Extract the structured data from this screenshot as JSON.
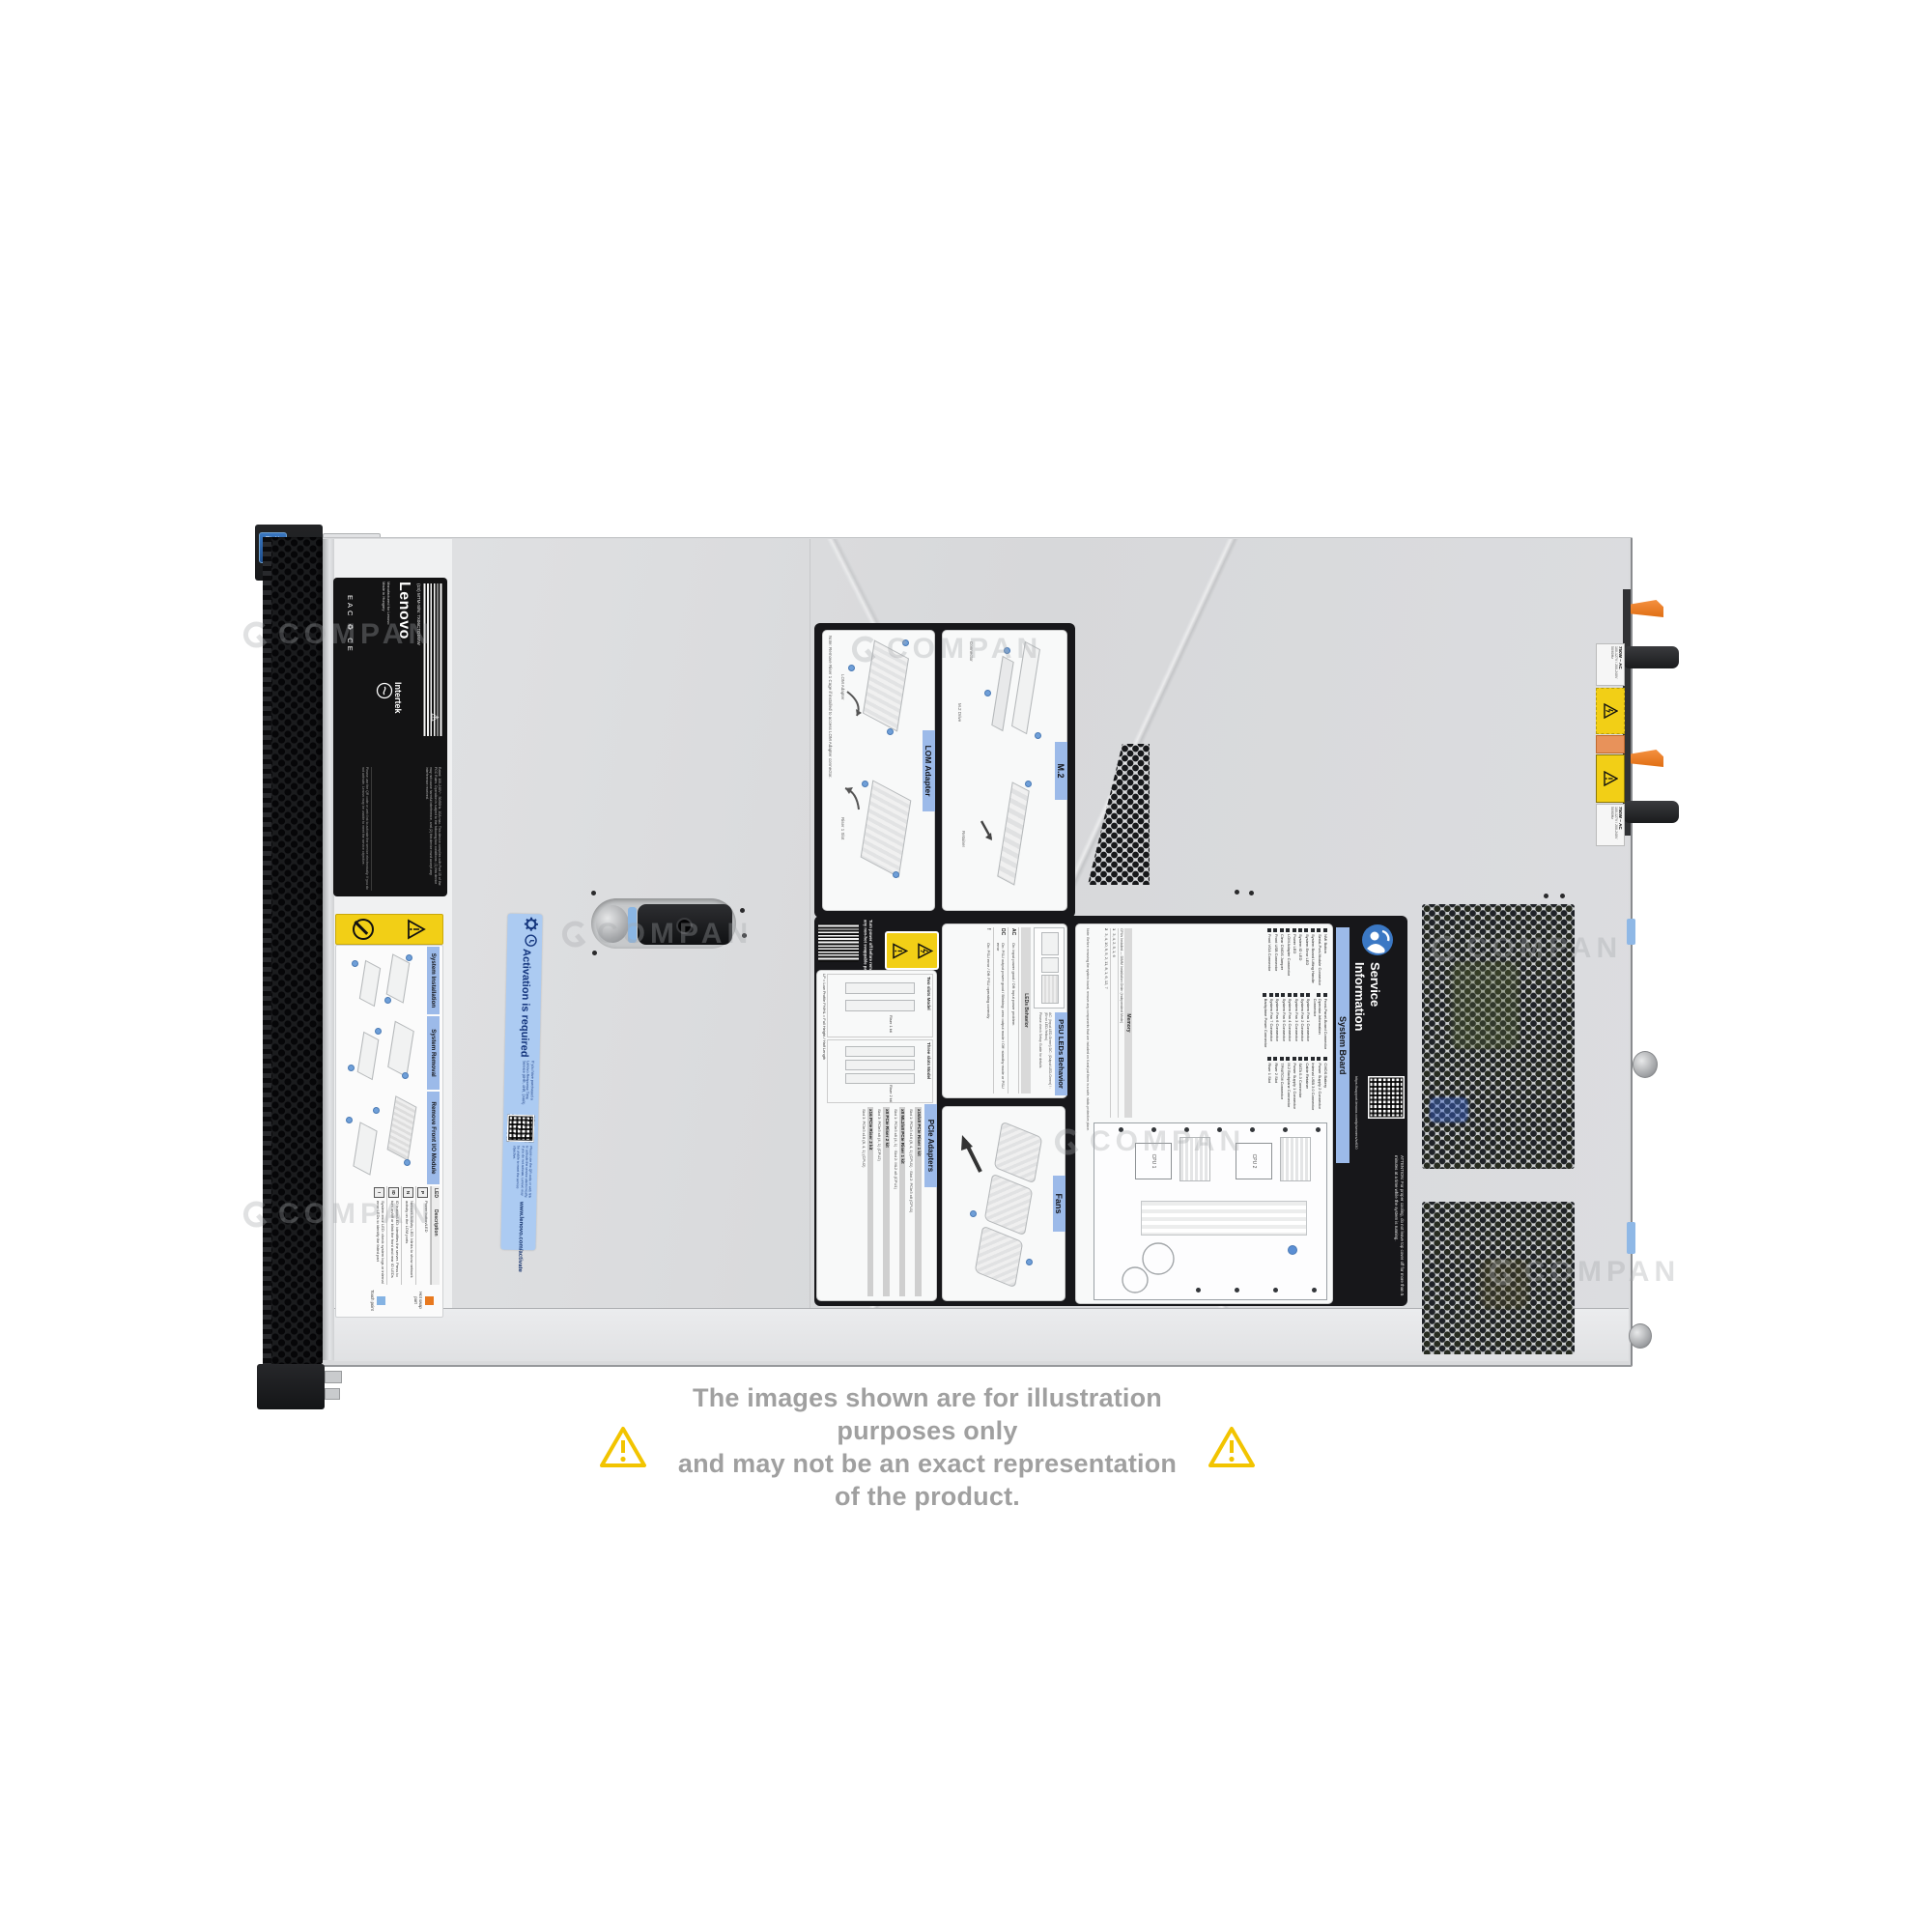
{
  "watermark": {
    "text": "COMPAN"
  },
  "disclaimer": {
    "line1": "The images shown are for illustration purposes only",
    "line2": "and may not be an exact representation of the product."
  },
  "product": {
    "brand": "Lenovo",
    "model_label": "(1S) MTM-S/N: 7X06CTO1WW",
    "made1": "Manufactured for Lenovo",
    "made2": "Made in Hungary",
    "cert": "Intertek",
    "marks": "EAC  ♻  CE",
    "badge1": "intel",
    "badge2": "XEON",
    "fineprint": "Rated: 100-240V~, 50/60Hz, 10A max. This device complies with Part 15 of the FCC Rules. Operation is subject to the following two conditions: (1) this device may not cause harmful interference, and (2) this device must accept any interference received."
  },
  "front_label": {
    "sections": [
      {
        "title": "System Installation"
      },
      {
        "title": "System Removal"
      },
      {
        "title": "Remove Front I/O Module"
      }
    ],
    "led_table": {
      "col1": "LED",
      "col2": "Description",
      "rows": [
        {
          "icon": "P",
          "text": "Power button/LED"
        },
        {
          "icon": "N",
          "text": "Network Activity LED: blinks to show network activity on the LOM ports"
        },
        {
          "icon": "ID",
          "text": "ID button/LED: identifies the server. Press to turn on/off or blink the front and rear ID LEDs"
        },
        {
          "icon": "!",
          "text": "System error LED: check system logs or internal error LEDs to identify the failed part"
        }
      ]
    },
    "legend": [
      {
        "label": "Hot swap part"
      },
      {
        "label": "Touch point"
      }
    ]
  },
  "activation": {
    "title": "Activation is required",
    "body": "If you have purchased a Lenovo Response Time Service (6HR, 4HR, 24HR)",
    "note": "Please use the QR code or web link to activate the service electronically. If you do not activate, Lenovo may be unable to meet the service objective.",
    "url": "www.lenovo.com/activate"
  },
  "service_label": {
    "turn_power": "Turn power off before removing any non-hot swappable part.",
    "lom": {
      "title": "LOM Adapter",
      "note": "Note: Remove Riser 1 Cage if installed to access LOM Adapter connector.",
      "cap1": "LOM Adapter",
      "cap2": "Riser 1 Slot"
    },
    "m2": {
      "title": "M.2",
      "cap1": "Connector",
      "cap2": "M.2 Drive",
      "cap3": "Retainer"
    },
    "psu": {
      "title": "PSU LEDs Behavior",
      "legend": "AC: (Input LED-Green)   DC: (Output LED-Green)   ! : (Error LED-Yellow)",
      "legend2": "Please check Setup Guide for details.",
      "bar": "LEDs Behavior",
      "rows": [
        {
          "tag": "AC",
          "text": "On: input power good / Off: input power problem"
        },
        {
          "tag": "DC",
          "text": "On: PSU output power good / Blinking: zero output mode / Off: standby mode or PSU error"
        },
        {
          "tag": "!",
          "text": "On: PSU error / Off: PSU operating correctly"
        }
      ]
    },
    "pcie": {
      "title": "PCIe Adapters",
      "model1": "Two slots Model",
      "model2": "Three slots Model",
      "riser1": "Riser 1 kit",
      "riser2": "Riser 2 kit",
      "profiles": "LP = Low Profile   FH/HL = Full Height / Half Length",
      "kits": [
        {
          "name": "x16/x8 PCIe Riser 1 kit",
          "rows": "Slot 1: PCIe3 x16 (8, 4, 1) (CPU1) · Slot 2: PCIe3 x8 (CPU1)"
        },
        {
          "name": "x8 ML2/x8 PCIe Riser 1 kit",
          "rows": "Slot 1: PCIe3 x8 (4, 1) · Slot 2: ML2 x8 (CPU1)"
        },
        {
          "name": "x8 PCIe Riser 2 kit",
          "rows": "Slot 3: PCIe3 x8 (4, 1) (CPU2)"
        },
        {
          "name": "x16 PCIe Riser 2 kit",
          "rows": "Slot 3: PCIe3 x16 (8, 4, 1) (CPU2)"
        }
      ]
    },
    "fans": {
      "title": "Fans"
    },
    "system_board": {
      "title": "System Board",
      "note": "Note: Before removing the system board, remove any components that are included on it and put them in a safe, static-protective place.",
      "connectors": [
        "NMI Button",
        "Serial-Port-Module Connector",
        "System Board Lifting Handle",
        "System Error LED",
        "System ID LED",
        "Power LED",
        "LOM Adapter Connector",
        "Clear CMOS Jumper",
        "Front USB Connector",
        "Front VGA Connector",
        "Front-Panel-Board Connector",
        "Operator-Information Connector",
        "System Fan 1 Connector",
        "System Fan 2 Connector",
        "System Fan 3 Connector",
        "System Fan 4 Connector",
        "System Fan 5 Connector",
        "System Fan 6 Connector",
        "System Fan 7 Connector",
        "Backplane Power Connector",
        "CMOS Battery",
        "Power Supply 2 Connector",
        "Internal USB 3.0 Connector",
        "Cable Retainer",
        "SATA 0-3 Connector",
        "Power Supply 1 Connector",
        "M.2 Backplane Connector",
        "TPM/TCM Connector",
        "Riser 2 Slot",
        "Riser 1 Slot"
      ],
      "memory": {
        "title": "Memory",
        "subtitle": "CPUs Installed — DIMM Installation Order (Independent Mode)",
        "rows": [
          {
            "k": "1",
            "v": "3, 4, 2, 5, 1, 6"
          },
          {
            "k": "2",
            "v": "3, 4, 10, 9, 5, 2, 11, 8, 1, 6, 12, 7"
          }
        ]
      },
      "cpu1": "CPU 1",
      "cpu2": "CPU 2"
    },
    "service_info": {
      "t1": "Service",
      "t2": "Information",
      "url": "https://support.lenovo.com/p/servers/sr630",
      "attention": "ATTENTION: For proper cooling, do not leave top cover off for more than 5 minutes at a time while the system is running."
    }
  },
  "rear": {
    "psu_rating": "750W ~ AC",
    "psu_lines": "100-127V / 200-240V  50/60Hz"
  },
  "colors": {
    "accent_blue_bar": "#9cbae9",
    "label_yellow": "#f2cf16",
    "hot_swap_orange": "#e8791f",
    "touch_blue": "#85b3e3",
    "activation_bg": "#accbf2"
  }
}
